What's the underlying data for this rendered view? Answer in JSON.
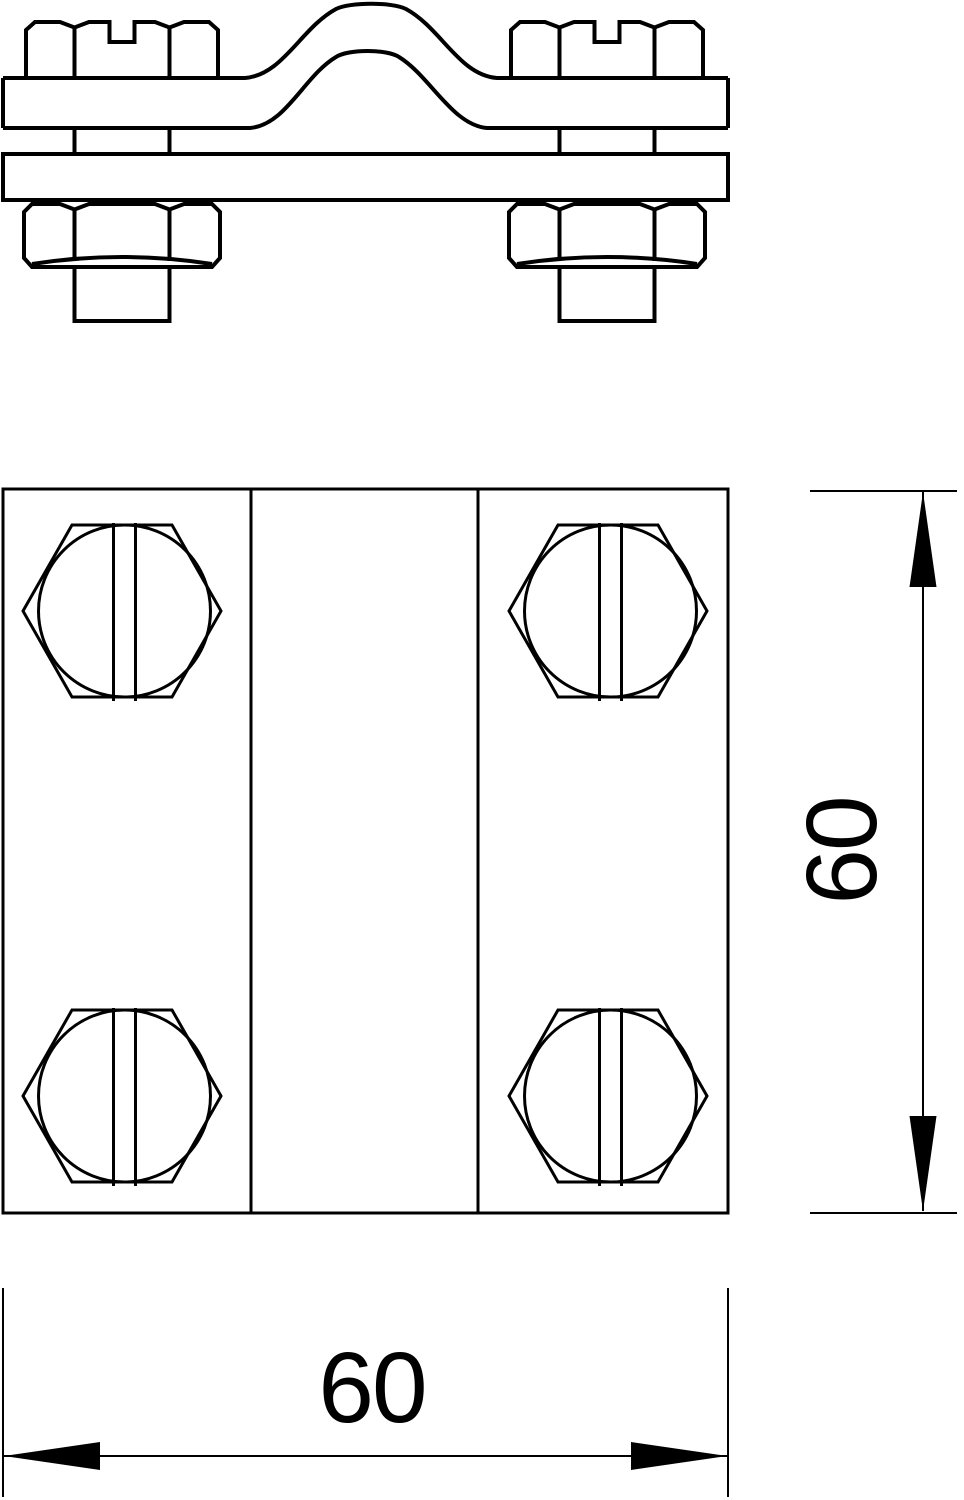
{
  "drawing": {
    "background": "#ffffff",
    "line_color": "#000000",
    "text_color": "#000000",
    "dimensions": {
      "width_label": "60",
      "height_label": "60"
    }
  }
}
